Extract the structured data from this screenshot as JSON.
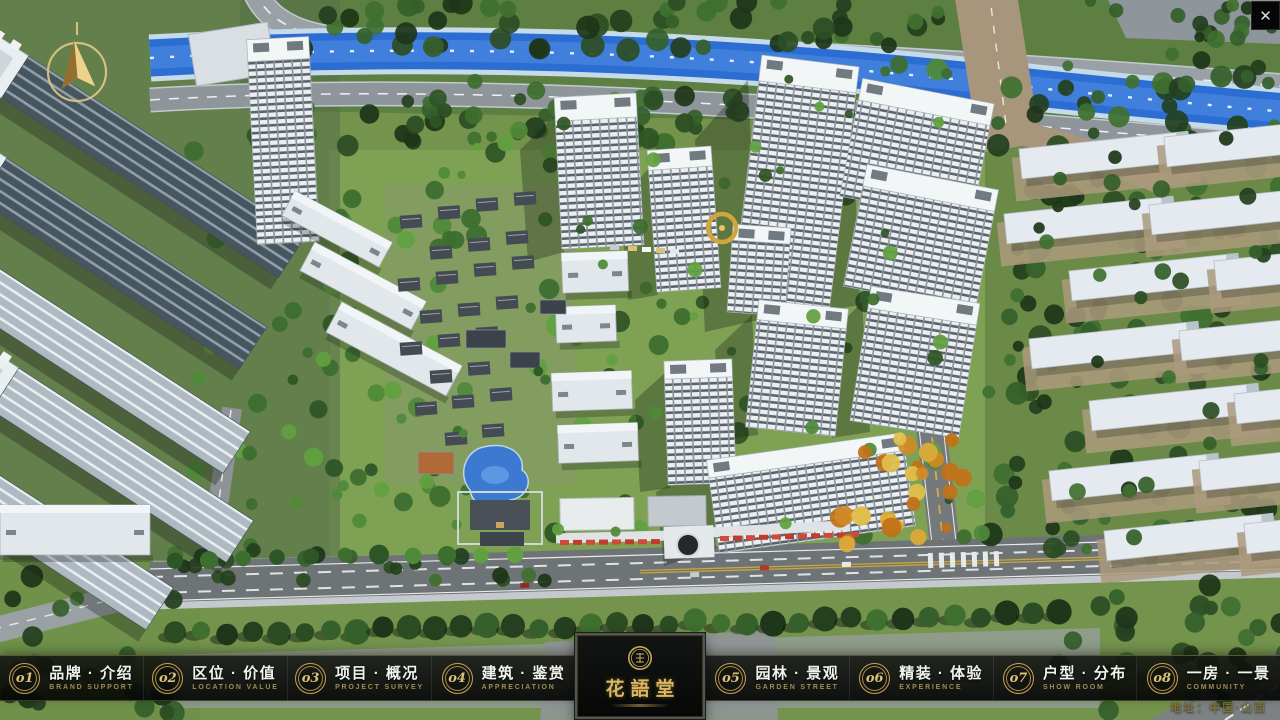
{
  "icons": {
    "close": "✕"
  },
  "nav": {
    "items": [
      {
        "num": "o1",
        "zh": "品牌 · 介绍",
        "en": "BRAND SUPPORT"
      },
      {
        "num": "o2",
        "zh": "区位 · 价值",
        "en": "LOCATION VALUE"
      },
      {
        "num": "o3",
        "zh": "项目 · 概况",
        "en": "PROJECT SURVEY"
      },
      {
        "num": "o4",
        "zh": "建筑 · 鉴赏",
        "en": "APPRECIATION"
      },
      {
        "num": "o5",
        "zh": "园林 · 景观",
        "en": "GARDEN STREET"
      },
      {
        "num": "o6",
        "zh": "精装 · 体验",
        "en": "EXPERIENCE"
      },
      {
        "num": "o7",
        "zh": "户型 · 分布",
        "en": "SHOW ROOM"
      },
      {
        "num": "o8",
        "zh": "一房 · 一景",
        "en": "COMMUNITY"
      }
    ]
  },
  "logo": {
    "title": "花語堂"
  },
  "footer": {
    "address": "地址：中国·山西"
  },
  "colors": {
    "gold": "#c9a55a",
    "river_blue": "#2d6ed2",
    "bar_bg": "#0a0c0a"
  }
}
